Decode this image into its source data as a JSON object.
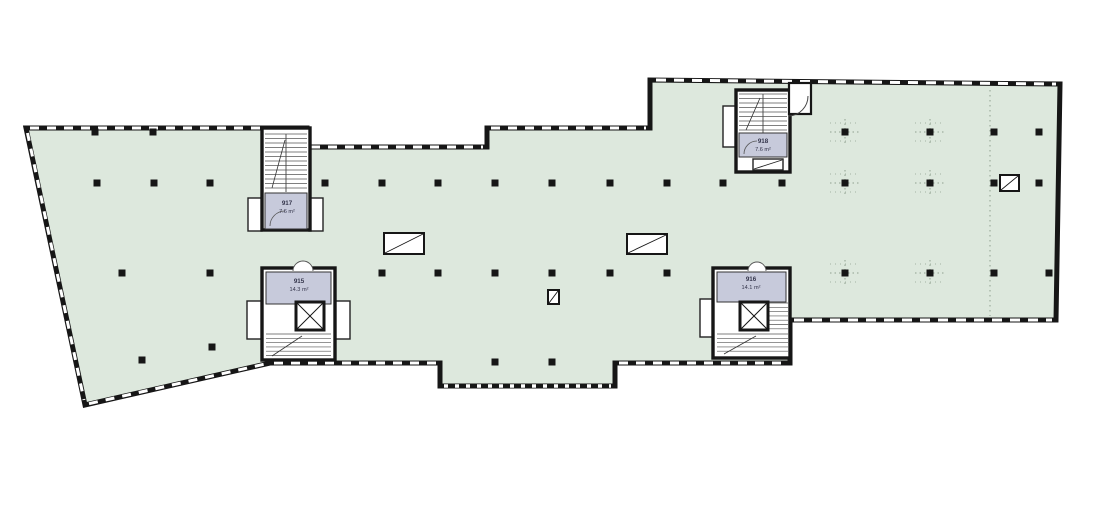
{
  "plan": {
    "title": "office-floor-plan",
    "colors": {
      "floor": "#dde8dd",
      "room": "#c7cadb",
      "wall": "#161616",
      "white": "#ffffff",
      "grid_dots": "#8fa08f"
    },
    "rooms": [
      {
        "id": "917",
        "area": "7.6 m²"
      },
      {
        "id": "918",
        "area": "7.6 m²"
      },
      {
        "id": "915",
        "area": "14.3 m²"
      },
      {
        "id": "916",
        "area": "14.1 m²"
      }
    ],
    "columns": [
      [
        95,
        132
      ],
      [
        153,
        132
      ],
      [
        97,
        183
      ],
      [
        154,
        183
      ],
      [
        210,
        183
      ],
      [
        325,
        183
      ],
      [
        382,
        183
      ],
      [
        438,
        183
      ],
      [
        495,
        183
      ],
      [
        552,
        183
      ],
      [
        610,
        183
      ],
      [
        667,
        183
      ],
      [
        723,
        183
      ],
      [
        782,
        183
      ],
      [
        122,
        273
      ],
      [
        210,
        273
      ],
      [
        382,
        273
      ],
      [
        438,
        273
      ],
      [
        495,
        273
      ],
      [
        552,
        273
      ],
      [
        610,
        273
      ],
      [
        667,
        273
      ],
      [
        142,
        360
      ],
      [
        212,
        347
      ],
      [
        495,
        362
      ],
      [
        552,
        362
      ],
      [
        845,
        132
      ],
      [
        930,
        132
      ],
      [
        994,
        132
      ],
      [
        1039,
        132
      ],
      [
        845,
        183
      ],
      [
        930,
        183
      ],
      [
        994,
        183
      ],
      [
        1039,
        183
      ],
      [
        845,
        273
      ],
      [
        930,
        273
      ],
      [
        994,
        273
      ],
      [
        1049,
        273
      ]
    ],
    "roof_openings": [
      {
        "x": 384,
        "y": 233,
        "w": 40,
        "h": 21
      },
      {
        "x": 627,
        "y": 234,
        "w": 40,
        "h": 20
      },
      {
        "x": 548,
        "y": 290,
        "w": 11,
        "h": 14
      },
      {
        "x": 1000,
        "y": 175,
        "w": 19,
        "h": 16
      }
    ]
  }
}
